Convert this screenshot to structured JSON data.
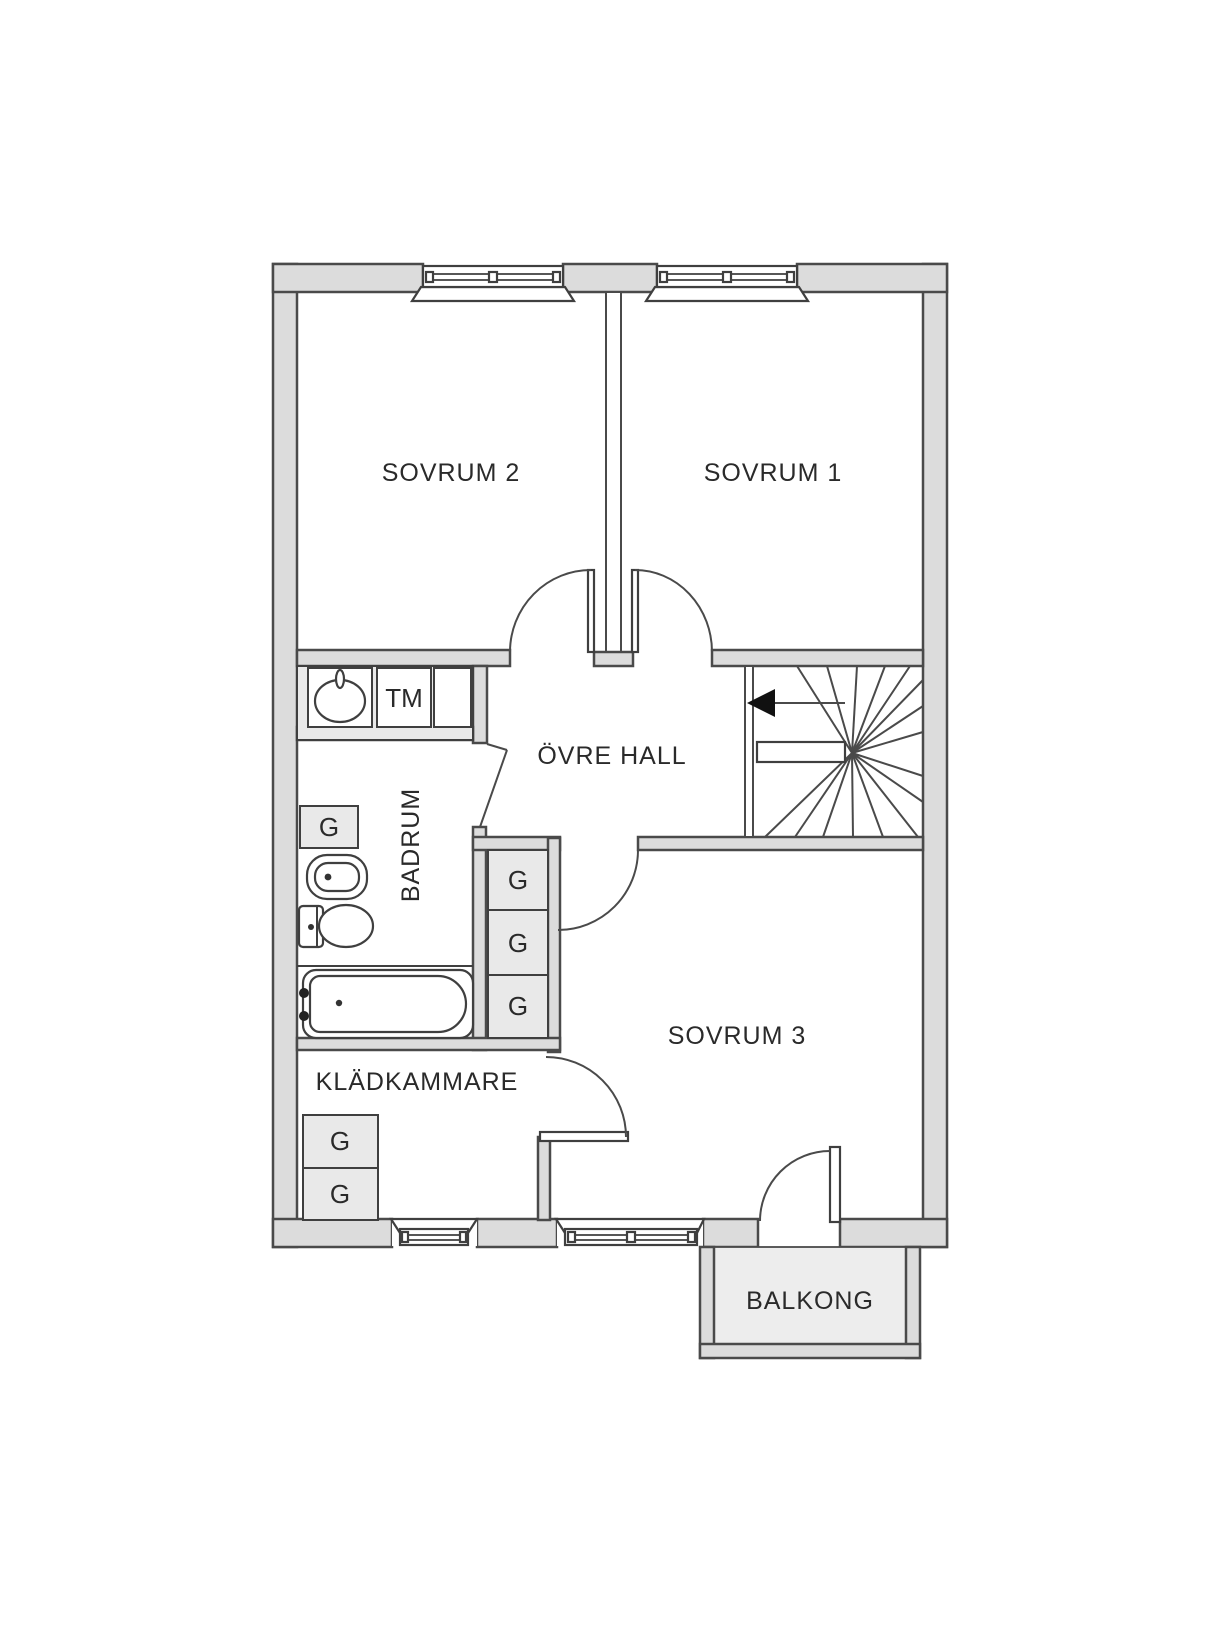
{
  "floorplan": {
    "rooms": {
      "sovrum1": "SOVRUM 1",
      "sovrum2": "SOVRUM 2",
      "sovrum3": "SOVRUM 3",
      "ovre_hall": "ÖVRE HALL",
      "badrum": "BADRUM",
      "kladkammare": "KLÄDKAMMARE",
      "balkong": "BALKONG"
    },
    "labels": {
      "tm": "TM",
      "g": "G"
    },
    "colors": {
      "wall_fill": "#dcdcdc",
      "outline": "#4a4a4a",
      "cabinet_fill": "#e9e9e9",
      "balcony_fill": "#ededed",
      "text": "#2a2a2a",
      "arrow": "#111111"
    }
  }
}
